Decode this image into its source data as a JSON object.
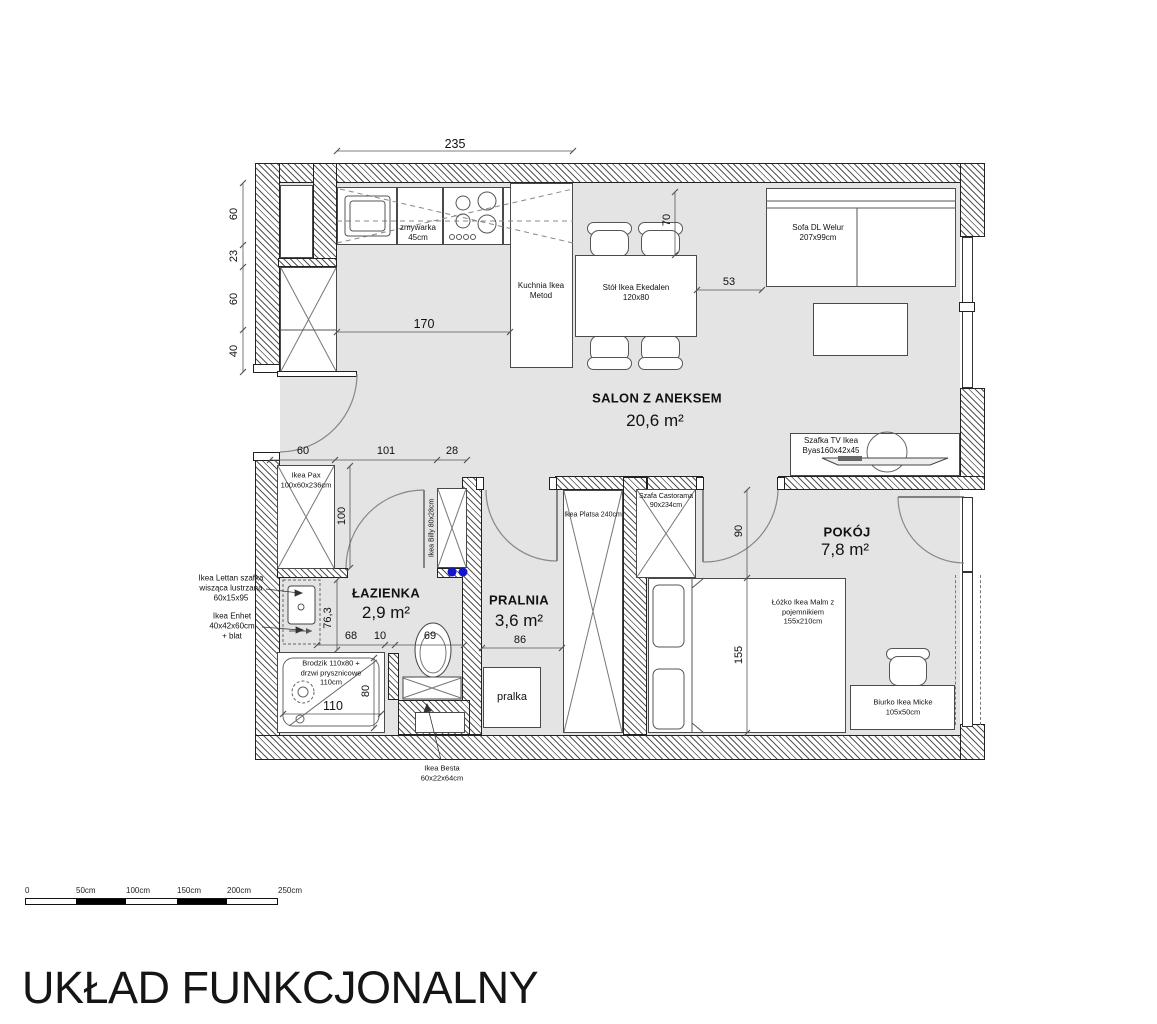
{
  "title": "UKŁAD FUNKCJONALNY",
  "rooms": {
    "salon": {
      "name": "SALON Z ANEKSEM",
      "area": "20,6 m²"
    },
    "lazienka": {
      "name": "ŁAZIENKA",
      "area": "2,9 m²"
    },
    "pralnia": {
      "name": "PRALNIA",
      "area": "3,6 m²"
    },
    "pokoj": {
      "name": "POKÓJ",
      "area": "7,8 m²"
    }
  },
  "furniture": {
    "zmywarka": [
      "zmywarka",
      "45cm"
    ],
    "kuchnia": [
      "Kuchnia Ikea",
      "Metod"
    ],
    "stol": [
      "Stół Ikea Ekedalen",
      "120x80"
    ],
    "sofa": [
      "Sofa DL Welur",
      "207x99cm"
    ],
    "tv": [
      "Szafka TV Ikea",
      "Byas160x42x45"
    ],
    "pax": [
      "Ikea Pax",
      "100x60x236cm"
    ],
    "billy": "Ikea Billy 80x28cm",
    "lettan": [
      "Ikea Lettan szafka",
      "wisząca lustrzana",
      "60x15x95"
    ],
    "enhet": [
      "Ikea Enhet",
      "40x42x60cm",
      "+ blat"
    ],
    "brodzik": [
      "Brodzik 110x80 +",
      "drzwi prysznicowe",
      "110cm"
    ],
    "besta": [
      "Ikea Besta",
      "60x22x64cm"
    ],
    "pralka": "pralka",
    "platsa": "Ikea Platsa 240cm",
    "szafa": [
      "Szafa Castorama",
      "90x234cm"
    ],
    "lozko": [
      "Łóżko Ikea Malm z",
      "pojemnikiem",
      "155x210cm"
    ],
    "biurko": [
      "Biurko Ikea Micke",
      "105x50cm"
    ]
  },
  "dims": {
    "top": "235",
    "kitchen_run": "170",
    "left": [
      "60",
      "23",
      "60",
      "40"
    ],
    "hall": [
      "60",
      "101",
      "28"
    ],
    "table_top": "70",
    "sofa_gap": "53",
    "pax": "100",
    "bath_side": "76,3",
    "bath_row": [
      "68",
      "10",
      "69"
    ],
    "shower_w": "110",
    "shower_h": "80",
    "pralnia_w": "86",
    "pokoj_door": "90",
    "bed_w": "155"
  },
  "scale_bar": [
    "0",
    "50cm",
    "100cm",
    "150cm",
    "200cm",
    "250cm"
  ],
  "colors": {
    "floor": "#e4e4e4",
    "wall_line": "#222222",
    "accent_blue": "#1414cc"
  }
}
